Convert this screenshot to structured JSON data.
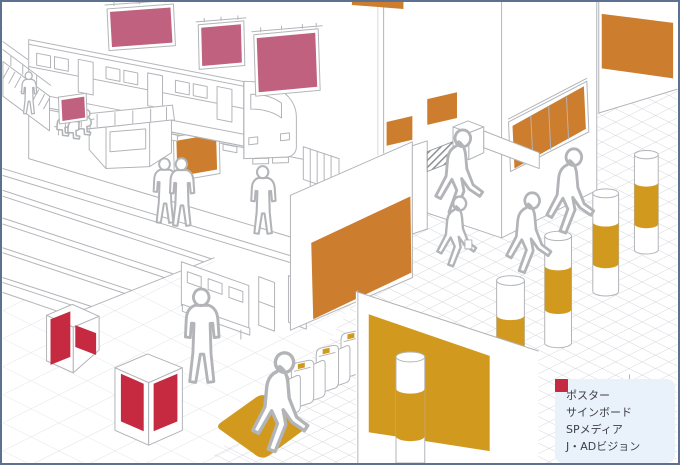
{
  "legend": {
    "items": [
      {
        "name": "poster",
        "label": "ポスター",
        "color": "#cd7d2e"
      },
      {
        "name": "signboard",
        "label": "サインボード",
        "color": "#c0617f"
      },
      {
        "name": "sp_media",
        "label": "SPメディア",
        "color": "#d19a1f"
      },
      {
        "name": "j_ad_vision",
        "label": "J・ADビジョン",
        "color": "#c52a40"
      }
    ]
  },
  "colors": {
    "poster": "#cd7d2e",
    "signboard": "#c0617f",
    "sp_media": "#d19a1f",
    "j_ad_vision": "#c52a40",
    "outline": "#b2b4b8",
    "outline_soft": "#c6cad0",
    "floor_line": "#c9cdd3",
    "legend_bg": "#e9f1fa",
    "frame_border": "#5d7090",
    "background": "#ffffff"
  }
}
